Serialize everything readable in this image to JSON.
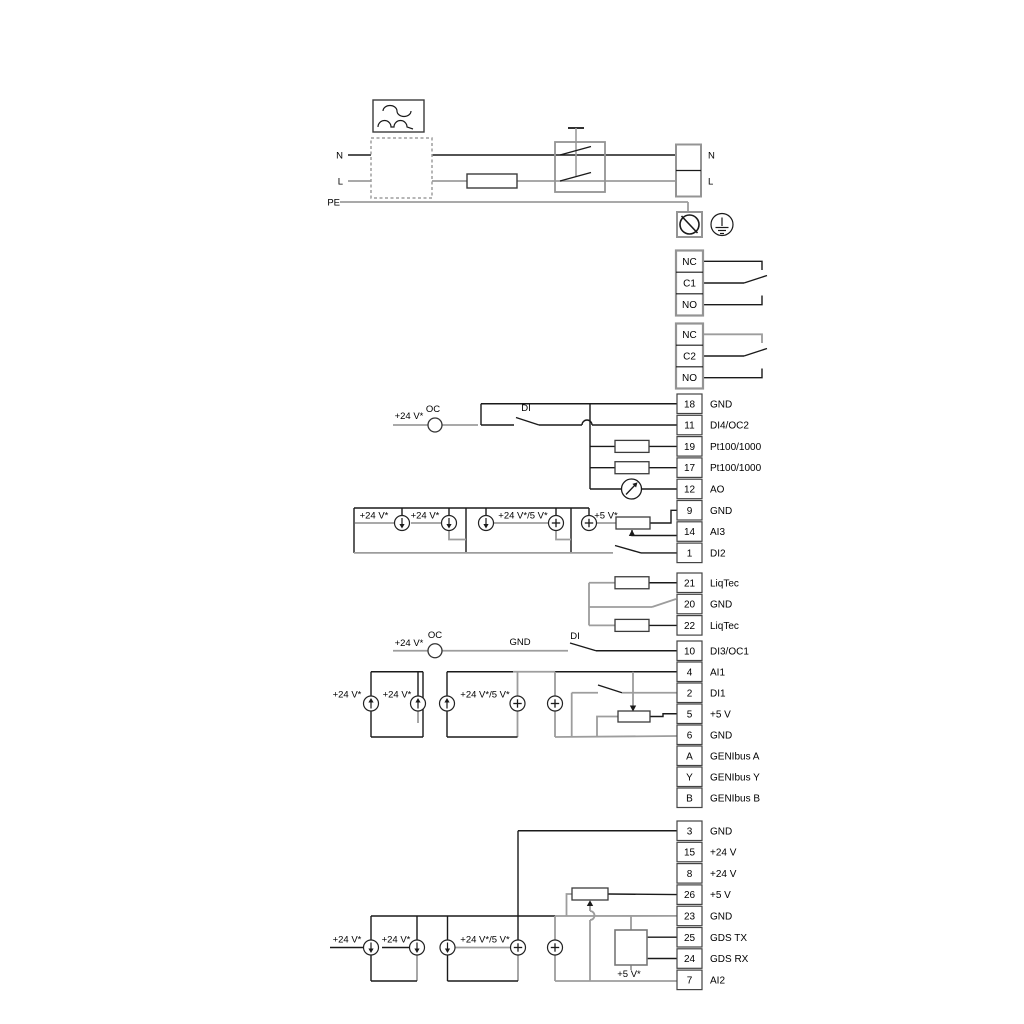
{
  "diagram": {
    "colors": {
      "background": "#ffffff",
      "wire_black": "#1a1a1a",
      "wire_gray": "#9d9d9d",
      "component_stroke": "#3c3c3c",
      "block_stroke": "#949494",
      "text": "#000000"
    },
    "power": {
      "source_left_labels": [
        "N",
        "L",
        "PE"
      ],
      "terminal_right_labels": [
        "N",
        "L"
      ]
    },
    "relays": [
      {
        "cells": [
          "NC",
          "C1",
          "NO"
        ]
      },
      {
        "cells": [
          "NC",
          "C2",
          "NO"
        ]
      }
    ],
    "strips": [
      {
        "name": "io-strip-1",
        "terminals": [
          {
            "num": "18",
            "label": "GND"
          },
          {
            "num": "11",
            "label": "DI4/OC2"
          },
          {
            "num": "19",
            "label": "Pt100/1000"
          },
          {
            "num": "17",
            "label": "Pt100/1000"
          },
          {
            "num": "12",
            "label": "AO"
          },
          {
            "num": "9",
            "label": "GND"
          },
          {
            "num": "14",
            "label": "AI3"
          },
          {
            "num": "1",
            "label": "DI2"
          }
        ]
      },
      {
        "name": "liqtec-strip",
        "terminals": [
          {
            "num": "21",
            "label": "LiqTec"
          },
          {
            "num": "20",
            "label": "GND"
          },
          {
            "num": "22",
            "label": "LiqTec"
          }
        ]
      },
      {
        "name": "io-strip-2",
        "terminals": [
          {
            "num": "10",
            "label": "DI3/OC1"
          },
          {
            "num": "4",
            "label": "AI1"
          },
          {
            "num": "2",
            "label": "DI1"
          },
          {
            "num": "5",
            "label": "+5 V"
          },
          {
            "num": "6",
            "label": "GND"
          },
          {
            "num": "A",
            "label": "GENIbus A"
          },
          {
            "num": "Y",
            "label": "GENIbus Y"
          },
          {
            "num": "B",
            "label": "GENIbus B"
          }
        ]
      },
      {
        "name": "io-strip-3",
        "terminals": [
          {
            "num": "3",
            "label": "GND"
          },
          {
            "num": "15",
            "label": "+24 V"
          },
          {
            "num": "8",
            "label": "+24 V"
          },
          {
            "num": "26",
            "label": "+5 V"
          },
          {
            "num": "23",
            "label": "GND"
          },
          {
            "num": "25",
            "label": "GDS TX"
          },
          {
            "num": "24",
            "label": "GDS RX"
          },
          {
            "num": "7",
            "label": "AI2"
          }
        ]
      }
    ],
    "wire_labels": {
      "n_left": "N",
      "l_left": "L",
      "pe_left": "PE",
      "n_right": "N",
      "l_right": "L",
      "s3_feed_24v": "+24 V*",
      "s3_oc": "OC",
      "s3_di": "DI",
      "s3_c1": "+24 V*",
      "s3_c2": "+24 V*",
      "s3_c3": "+24 V*/5 V*",
      "s3_c5": "+5 V*",
      "sm_feed_24v": "+24 V*",
      "sm_oc": "OC",
      "sm_gnd": "GND",
      "sm_di": "DI",
      "sm_c1": "+24 V*",
      "sm_c2": "+24 V*",
      "sm_c3": "+24 V*/5 V*",
      "sb_c1": "+24 V*",
      "sb_c2": "+24 V*",
      "sb_c3": "+24 V*/5 V*",
      "sb_5v": "+5 V*"
    }
  }
}
